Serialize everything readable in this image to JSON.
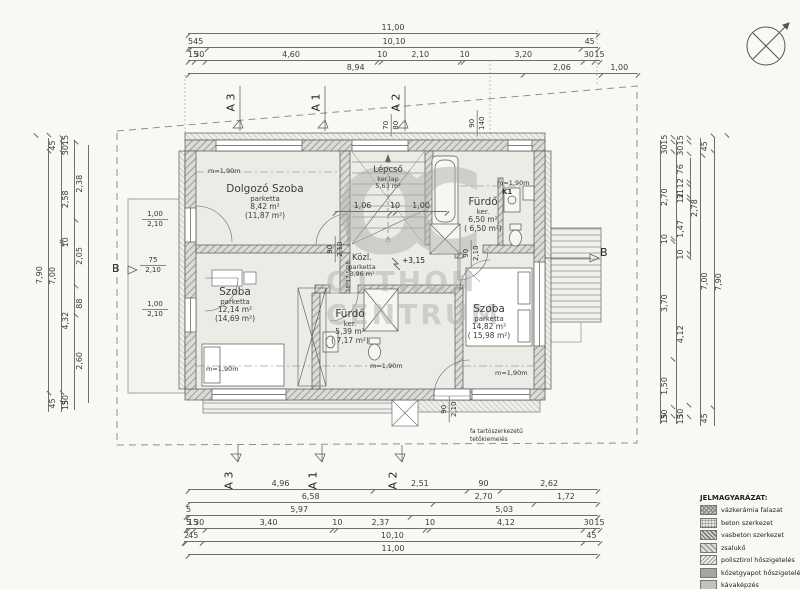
{
  "watermark": {
    "monogram": "OC",
    "line1": "OTTHON",
    "line2": "CENTRUM"
  },
  "rooms": [
    {
      "name": "Dolgozó Szoba",
      "floor": "parketta",
      "area": "8,42 m²",
      "area_gross": "(11,87 m²)"
    },
    {
      "name": "Lépcső",
      "floor": "ker.lap",
      "area": "5,63 m²",
      "area_gross": ""
    },
    {
      "name": "Fürdő",
      "floor": "ker.",
      "area": "6,50 m²",
      "area_gross": "( 6,50 m²)"
    },
    {
      "name": "Közl.",
      "floor": "parketta",
      "area": "3,96 m²",
      "area_gross": ""
    },
    {
      "name": "Szoba",
      "floor": "parketta",
      "area": "12,14 m²",
      "area_gross": "(14,69 m²)"
    },
    {
      "name": "Fürdő",
      "floor": "ker.",
      "area": "5,39 m²",
      "area_gross": "( 7,17 m²)"
    },
    {
      "name": "Szoba",
      "floor": "parketta",
      "area": "14,82 m²",
      "area_gross": "( 15,98 m²)"
    }
  ],
  "labels": {
    "k1": "K1",
    "m190": "m=1,90m",
    "level": "+3,15",
    "stair_spec": "18*17,5/28",
    "roof_note_1": "fa tartószerkezetű",
    "roof_note_2": "tetőkiemelés"
  },
  "sections": {
    "a3": "A 3",
    "a1": "A 1",
    "a2": "A 2",
    "b": "B"
  },
  "dims": {
    "top": [
      [
        "11,00"
      ],
      [
        "5",
        "45",
        "10,10",
        "45"
      ],
      [
        "15",
        "30",
        "4,60",
        "10",
        "2,10",
        "10",
        "3,20",
        "30",
        "15"
      ],
      [
        "8,94",
        "2,06",
        "1,00"
      ]
    ],
    "bottom": [
      [
        "4,96",
        "2,51",
        "90",
        "2,62"
      ],
      [
        "6,58",
        "2,70",
        "1,72"
      ],
      [
        "5",
        "5,97",
        "5,03"
      ],
      [
        "5",
        "15",
        "30",
        "3,40",
        "10",
        "2,37",
        "10",
        "4,12",
        "30",
        "15"
      ],
      [
        "2",
        "45",
        "10,10",
        "45"
      ],
      [
        "11,00"
      ]
    ],
    "left": [
      [
        "7,90"
      ],
      [
        "45",
        "7,00",
        "45"
      ],
      [
        "15",
        "30",
        "2,58",
        "10",
        "4,32",
        "30",
        "15"
      ],
      [
        "2,38",
        "2,05",
        "88",
        "2,60"
      ]
    ],
    "right": [
      [
        "15",
        "30",
        "2,70",
        "10",
        "3,70",
        "1,50",
        "30",
        "15"
      ],
      [
        "15",
        "30",
        "76",
        "12",
        "31",
        "12",
        "1,47",
        "10",
        "4,12",
        "30",
        "15"
      ],
      [
        "2,78"
      ],
      [
        "45",
        "7,00",
        "45"
      ],
      [
        "7,90"
      ]
    ],
    "stairs_top": [
      "1,06",
      "10",
      "1,00"
    ]
  },
  "openings": [
    {
      "a": "1,00",
      "b": "2,10"
    },
    {
      "a": "75",
      "b": "2,10"
    },
    {
      "a": "1,00",
      "b": "2,10"
    },
    {
      "a": "90",
      "b": "2,10"
    },
    {
      "a": "90",
      "b": "2,10"
    },
    {
      "a": "90",
      "b": "2,10"
    },
    {
      "a": "70",
      "b": "80"
    },
    {
      "a": "90",
      "b": "140"
    }
  ],
  "legend": {
    "title": "JELMAGYARÁZAT:",
    "items": [
      {
        "label": "vázkerámia falazat",
        "swatch": "crosshatch"
      },
      {
        "label": "beton szerkezet",
        "swatch": "dots"
      },
      {
        "label": "vasbeton szerkezet",
        "swatch": "hatch-dense"
      },
      {
        "label": "zsalukő",
        "swatch": "hatch"
      },
      {
        "label": "polisztirol hőszigetelés",
        "swatch": "hatch-light"
      },
      {
        "label": "kőzetgyapot hőszigetelés",
        "swatch": "solid-dark"
      },
      {
        "label": "kávaképzés",
        "swatch": "solid-light"
      }
    ]
  },
  "colors": {
    "paper": "#f9f8f5",
    "ink": "#4a4a4a",
    "wall": "#dddbd6",
    "room": "#ecebe6",
    "watermark": "#b0b0ae"
  }
}
